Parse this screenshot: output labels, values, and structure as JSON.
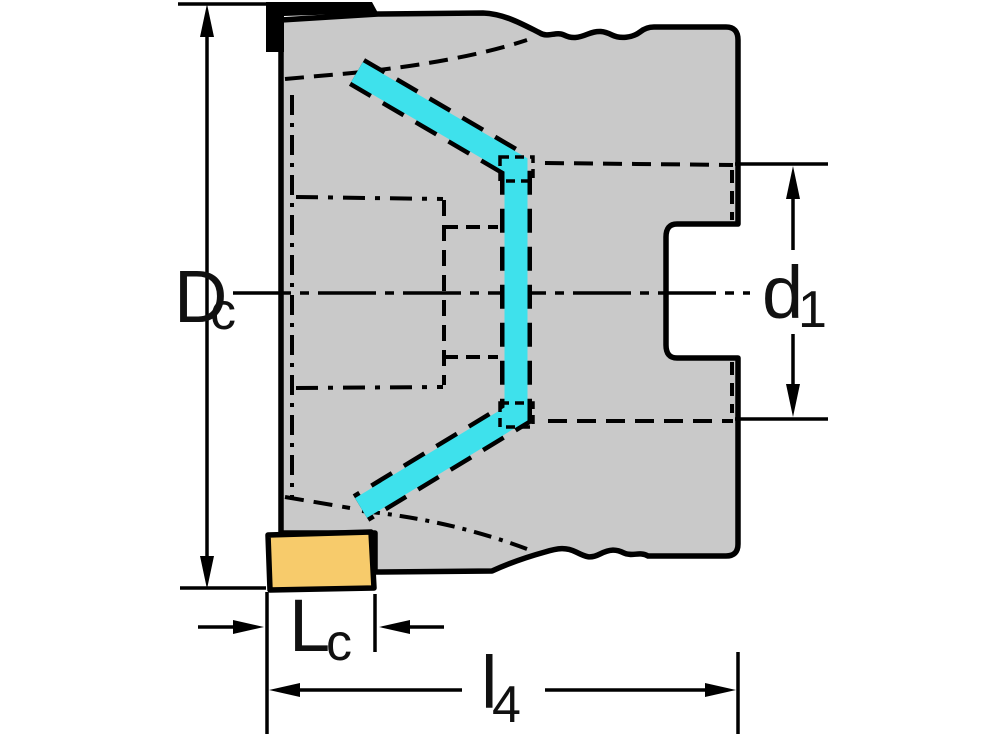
{
  "diagram": {
    "type": "technical-drawing",
    "subject": "face-milling-cutter-side-view",
    "dimension_labels": {
      "dc": {
        "main": "D",
        "sub": "c"
      },
      "d1": {
        "main": "d",
        "sub": "1"
      },
      "lc": {
        "main": "L",
        "sub": "c"
      },
      "l4": {
        "main": "l",
        "sub": "4"
      }
    },
    "colors": {
      "background": "#ffffff",
      "body_fill": "#c9c9c9",
      "outline": "#000000",
      "highlight": "#3ee1ec",
      "insert_fill": "#f7cb6b"
    }
  }
}
